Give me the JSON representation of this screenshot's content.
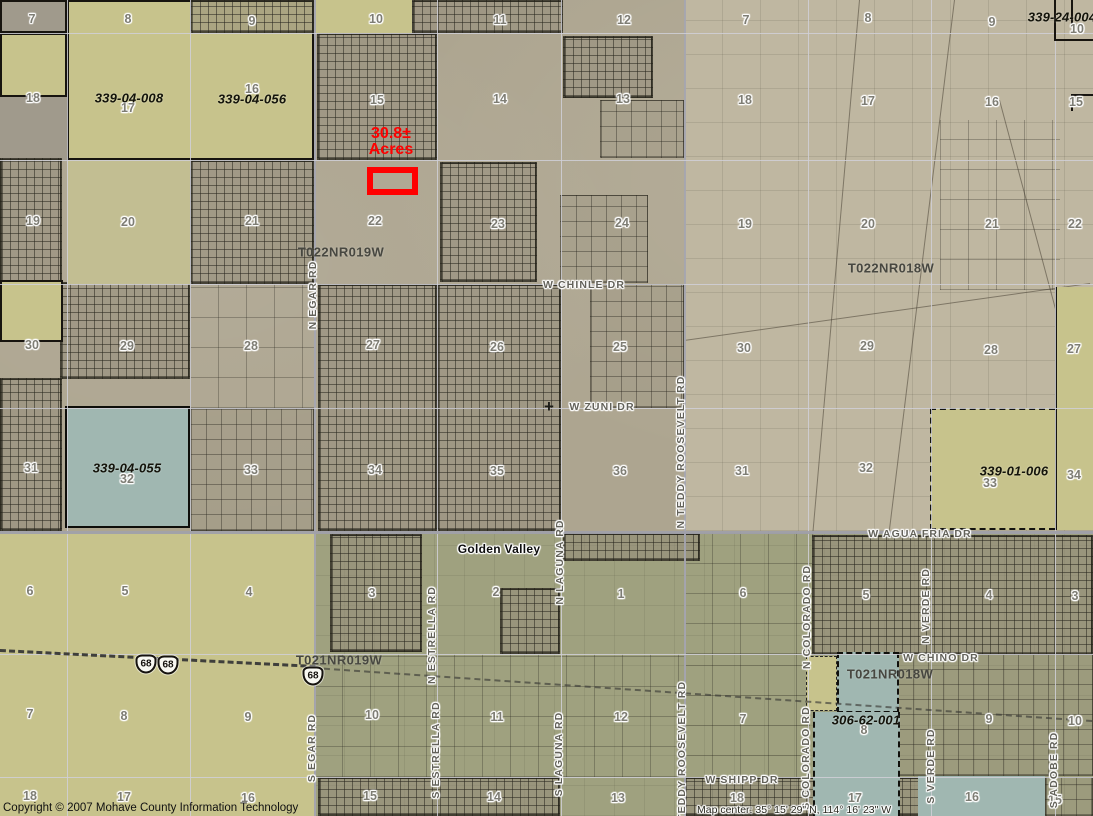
{
  "map": {
    "width": 1093,
    "height": 816,
    "place_label": "Golden Valley",
    "annotation": {
      "line1": "30.8±",
      "line2": "Acres",
      "color": "#ff0000",
      "box": {
        "x": 351,
        "y": 126,
        "w": 80
      },
      "rect": {
        "x": 367,
        "y": 167,
        "w": 51,
        "h": 28
      }
    },
    "footer": {
      "copyright": "Copyright © 2007 Mohave County Information Technology",
      "map_center": "Map center: 35° 15' 29\" N, 114° 16' 23\" W"
    },
    "townships": [
      {
        "text": "T022NR019W",
        "x": 341,
        "y": 252
      },
      {
        "text": "T022NR018W",
        "x": 891,
        "y": 268
      },
      {
        "text": "T021NR019W",
        "x": 339,
        "y": 660
      },
      {
        "text": "T021NR018W",
        "x": 890,
        "y": 674
      }
    ],
    "parcels": [
      {
        "id": "339-04-008",
        "x": 129,
        "y": 98
      },
      {
        "id": "339-04-056",
        "x": 252,
        "y": 99
      },
      {
        "id": "339-04-055",
        "x": 127,
        "y": 468
      },
      {
        "id": "339-01-006",
        "x": 1014,
        "y": 471
      },
      {
        "id": "306-62-001",
        "x": 866,
        "y": 720
      },
      {
        "id": "339-24-004",
        "x": 1062,
        "y": 17
      }
    ],
    "roads_h": [
      {
        "name": "W CHINLE DR",
        "x": 584,
        "y": 285
      },
      {
        "name": "W ZUNI DR",
        "x": 602,
        "y": 407
      },
      {
        "name": "W AGUA FRIA DR",
        "x": 920,
        "y": 534
      },
      {
        "name": "W CHINO DR",
        "x": 941,
        "y": 658
      },
      {
        "name": "W SHIPP DR",
        "x": 742,
        "y": 780
      }
    ],
    "roads_v": [
      {
        "name": "N EGAR RD",
        "x": 313,
        "y": 295
      },
      {
        "name": "N TEDDY ROOSEVELT RD",
        "x": 681,
        "y": 452
      },
      {
        "name": "N LAGUNA RD",
        "x": 560,
        "y": 562
      },
      {
        "name": "N ESTRELLA RD",
        "x": 432,
        "y": 635
      },
      {
        "name": "N COLORADO RD",
        "x": 807,
        "y": 617
      },
      {
        "name": "N VERDE RD",
        "x": 926,
        "y": 606
      },
      {
        "name": "S EGAR RD",
        "x": 312,
        "y": 748
      },
      {
        "name": "S ESTRELLA RD",
        "x": 436,
        "y": 750
      },
      {
        "name": "S LAGUNA RD",
        "x": 559,
        "y": 754
      },
      {
        "name": "S TEDDY ROOSEVELT RD",
        "x": 682,
        "y": 757
      },
      {
        "name": "S COLORADO RD",
        "x": 806,
        "y": 758
      },
      {
        "name": "S VERDE RD",
        "x": 931,
        "y": 766
      },
      {
        "name": "S ADOBE RD",
        "x": 1054,
        "y": 770
      }
    ],
    "shields": [
      {
        "label": "68",
        "x": 146,
        "y": 664
      },
      {
        "label": "68",
        "x": 168,
        "y": 665
      },
      {
        "label": "68",
        "x": 313,
        "y": 676
      }
    ],
    "sections": [
      {
        "n": "7",
        "x": 32,
        "y": 19
      },
      {
        "n": "8",
        "x": 128,
        "y": 19
      },
      {
        "n": "9",
        "x": 252,
        "y": 21
      },
      {
        "n": "10",
        "x": 376,
        "y": 19
      },
      {
        "n": "11",
        "x": 500,
        "y": 20
      },
      {
        "n": "12",
        "x": 624,
        "y": 20
      },
      {
        "n": "18",
        "x": 33,
        "y": 98
      },
      {
        "n": "17",
        "x": 128,
        "y": 108
      },
      {
        "n": "16",
        "x": 252,
        "y": 89
      },
      {
        "n": "15",
        "x": 377,
        "y": 100
      },
      {
        "n": "14",
        "x": 500,
        "y": 99
      },
      {
        "n": "13",
        "x": 623,
        "y": 99
      },
      {
        "n": "19",
        "x": 33,
        "y": 221
      },
      {
        "n": "20",
        "x": 128,
        "y": 222
      },
      {
        "n": "21",
        "x": 252,
        "y": 221
      },
      {
        "n": "22",
        "x": 375,
        "y": 221
      },
      {
        "n": "23",
        "x": 498,
        "y": 224
      },
      {
        "n": "24",
        "x": 622,
        "y": 223
      },
      {
        "n": "30",
        "x": 32,
        "y": 345
      },
      {
        "n": "29",
        "x": 127,
        "y": 346
      },
      {
        "n": "28",
        "x": 251,
        "y": 346
      },
      {
        "n": "27",
        "x": 373,
        "y": 345
      },
      {
        "n": "26",
        "x": 497,
        "y": 347
      },
      {
        "n": "25",
        "x": 620,
        "y": 347
      },
      {
        "n": "31",
        "x": 31,
        "y": 468
      },
      {
        "n": "32",
        "x": 127,
        "y": 479
      },
      {
        "n": "33",
        "x": 251,
        "y": 470
      },
      {
        "n": "34",
        "x": 375,
        "y": 470
      },
      {
        "n": "35",
        "x": 497,
        "y": 471
      },
      {
        "n": "36",
        "x": 620,
        "y": 471
      },
      {
        "n": "7",
        "x": 746,
        "y": 20
      },
      {
        "n": "8",
        "x": 868,
        "y": 18
      },
      {
        "n": "9",
        "x": 992,
        "y": 22
      },
      {
        "n": "10",
        "x": 1077,
        "y": 29
      },
      {
        "n": "18",
        "x": 745,
        "y": 100
      },
      {
        "n": "17",
        "x": 868,
        "y": 101
      },
      {
        "n": "16",
        "x": 992,
        "y": 102
      },
      {
        "n": "15",
        "x": 1076,
        "y": 102
      },
      {
        "n": "19",
        "x": 745,
        "y": 224
      },
      {
        "n": "20",
        "x": 868,
        "y": 224
      },
      {
        "n": "21",
        "x": 992,
        "y": 224
      },
      {
        "n": "22",
        "x": 1075,
        "y": 224
      },
      {
        "n": "30",
        "x": 744,
        "y": 348
      },
      {
        "n": "29",
        "x": 867,
        "y": 346
      },
      {
        "n": "28",
        "x": 991,
        "y": 350
      },
      {
        "n": "27",
        "x": 1074,
        "y": 349
      },
      {
        "n": "31",
        "x": 742,
        "y": 471
      },
      {
        "n": "32",
        "x": 866,
        "y": 468
      },
      {
        "n": "33",
        "x": 990,
        "y": 483
      },
      {
        "n": "34",
        "x": 1074,
        "y": 475
      },
      {
        "n": "6",
        "x": 30,
        "y": 591
      },
      {
        "n": "5",
        "x": 125,
        "y": 591
      },
      {
        "n": "4",
        "x": 249,
        "y": 592
      },
      {
        "n": "3",
        "x": 372,
        "y": 593
      },
      {
        "n": "2",
        "x": 496,
        "y": 592
      },
      {
        "n": "1",
        "x": 621,
        "y": 594
      },
      {
        "n": "7",
        "x": 30,
        "y": 714
      },
      {
        "n": "8",
        "x": 124,
        "y": 716
      },
      {
        "n": "9",
        "x": 248,
        "y": 717
      },
      {
        "n": "10",
        "x": 372,
        "y": 715
      },
      {
        "n": "11",
        "x": 497,
        "y": 717
      },
      {
        "n": "12",
        "x": 621,
        "y": 717
      },
      {
        "n": "18",
        "x": 30,
        "y": 796
      },
      {
        "n": "17",
        "x": 124,
        "y": 797
      },
      {
        "n": "16",
        "x": 248,
        "y": 798
      },
      {
        "n": "15",
        "x": 370,
        "y": 796
      },
      {
        "n": "14",
        "x": 494,
        "y": 797
      },
      {
        "n": "13",
        "x": 618,
        "y": 798
      },
      {
        "n": "6",
        "x": 743,
        "y": 593
      },
      {
        "n": "5",
        "x": 866,
        "y": 595
      },
      {
        "n": "4",
        "x": 989,
        "y": 595
      },
      {
        "n": "3",
        "x": 1075,
        "y": 596
      },
      {
        "n": "7",
        "x": 743,
        "y": 719
      },
      {
        "n": "8",
        "x": 864,
        "y": 730
      },
      {
        "n": "9",
        "x": 989,
        "y": 719
      },
      {
        "n": "10",
        "x": 1075,
        "y": 721
      },
      {
        "n": "18",
        "x": 737,
        "y": 798
      },
      {
        "n": "17",
        "x": 855,
        "y": 798
      },
      {
        "n": "16",
        "x": 972,
        "y": 797
      },
      {
        "n": "15",
        "x": 1055,
        "y": 800
      }
    ],
    "colors": {
      "highlight_khaki": "#c7c38c",
      "selected_teal": "#a0b7b1",
      "annotation_red": "#ff0000",
      "aerial_gray": "#ada590",
      "aerial_tan": "#bfb7a1",
      "valley_green": "#9fa17f"
    }
  }
}
